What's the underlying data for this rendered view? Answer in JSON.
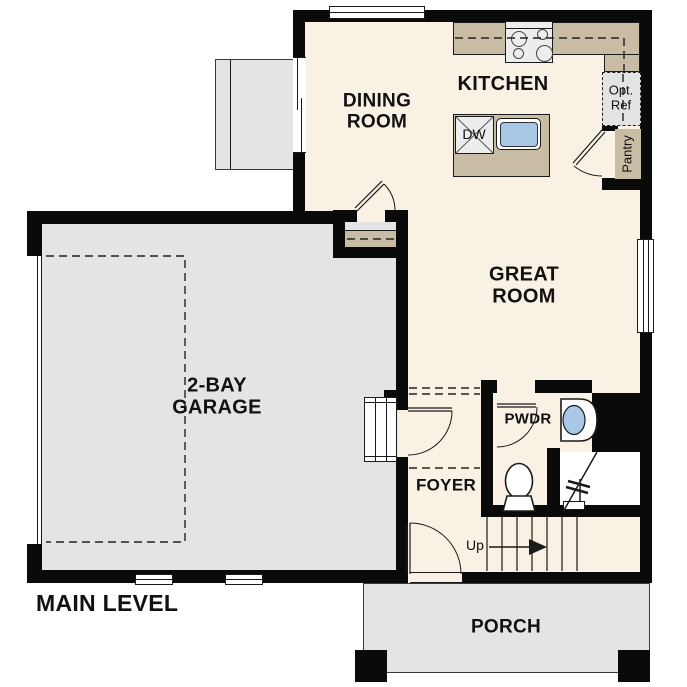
{
  "title": "MAIN LEVEL",
  "colors": {
    "floor": "#f8f1e4",
    "counter": "#c9bca4",
    "garage": "#e4e4e4",
    "wall": "#0a0a0a",
    "sink": "#a9c8e8",
    "appliance": "#ededed",
    "outline": "#1a1a1a",
    "paper": "#ffffff"
  },
  "rooms": {
    "dining": "DINING\nROOM",
    "kitchen": "KITCHEN",
    "great": "GREAT\nROOM",
    "garage": "2-BAY\nGARAGE",
    "foyer": "FOYER",
    "powder": "PWDR",
    "porch": "PORCH",
    "pantry": "Pantry",
    "opt_ref": "Opt.\nRef"
  },
  "labels": {
    "level": "MAIN LEVEL",
    "up": "Up",
    "dishwasher": "DW"
  }
}
